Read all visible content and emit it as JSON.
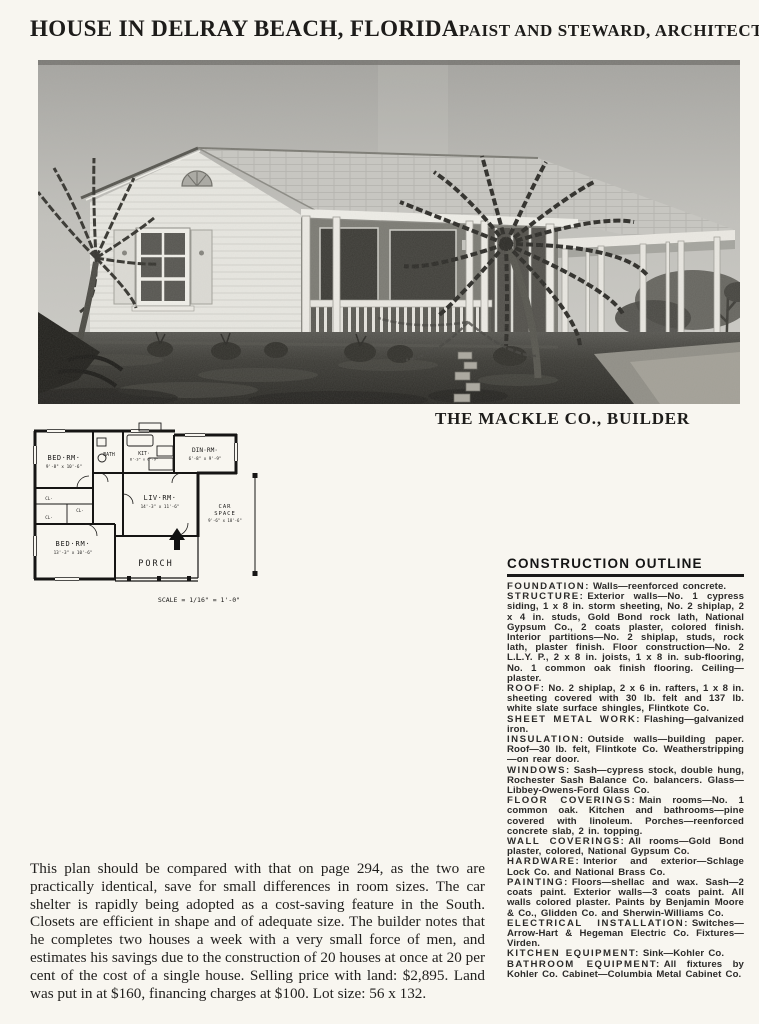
{
  "header": {
    "title": "HOUSE IN DELRAY BEACH, FLORIDA",
    "architects": "PAIST AND STEWARD, ARCHITECTS"
  },
  "photo": {
    "caption": "THE MACKLE CO., BUILDER"
  },
  "floor_plan": {
    "rooms": {
      "bedroom1": {
        "name": "BED·RM·",
        "dims": "9'-8\" x 10'-6\""
      },
      "bath": {
        "name": "BATH"
      },
      "kitchen": {
        "name": "KIT·",
        "dims": "8'-3\" x 6'-9\""
      },
      "dining": {
        "name": "DIN·RM·",
        "dims": "6'-8\" x 9'-9\""
      },
      "living": {
        "name": "LIV·RM·",
        "dims": "14'-3\" x 11'-6\""
      },
      "bedroom2": {
        "name": "BED·RM·",
        "dims": "13'-3\" x 10'-6\""
      },
      "porch": {
        "name": "PORCH"
      },
      "car_space": {
        "line1": "CAR",
        "line2": "SPACE",
        "dims": "9'-6\" x 18'-6\""
      }
    },
    "closet_label": "CL·",
    "scale": "SCALE = 1/16\" = 1'-0\""
  },
  "construction_outline": {
    "heading": "CONSTRUCTION OUTLINE",
    "items": [
      {
        "label": "FOUNDATION:",
        "text": "Walls—reenforced concrete."
      },
      {
        "label": "STRUCTURE:",
        "text": "Exterior walls—No. 1 cypress siding, 1 x 8 in. storm sheeting, No. 2 shiplap, 2 x 4 in. studs, Gold Bond rock lath, National Gypsum Co., 2 coats plaster, colored finish. Interior partitions—No. 2 shiplap, studs, rock lath, plaster finish. Floor construction—No. 2 L.L.Y. P., 2 x 8 in. joists, 1 x 8 in. sub-flooring, No. 1 common oak finish flooring. Ceiling—plaster."
      },
      {
        "label": "ROOF:",
        "text": "No. 2 shiplap, 2 x 6 in. rafters, 1 x 8 in. sheeting covered with 30 lb. felt and 137 lb. white slate surface shingles, Flintkote Co."
      },
      {
        "label": "SHEET METAL WORK:",
        "text": "Flashing—galvanized iron."
      },
      {
        "label": "INSULATION:",
        "text": "Outside walls—building paper. Roof—30 lb. felt, Flintkote Co. Weatherstripping—on rear door."
      },
      {
        "label": "WINDOWS:",
        "text": "Sash—cypress stock, double hung, Rochester Sash Balance Co. balancers. Glass—Libbey-Owens-Ford Glass Co."
      },
      {
        "label": "FLOOR COVERINGS:",
        "text": "Main rooms—No. 1 common oak. Kitchen and bathrooms—pine covered with linoleum. Porches—reenforced concrete slab, 2 in. topping."
      },
      {
        "label": "WALL COVERINGS:",
        "text": "All rooms—Gold Bond plaster, colored, National Gypsum Co."
      },
      {
        "label": "HARDWARE:",
        "text": "Interior and exterior—Schlage Lock Co. and National Brass Co."
      },
      {
        "label": "PAINTING:",
        "text": "Floors—shellac and wax. Sash—2 coats paint. Exterior walls—3 coats paint. All walls colored plaster. Paints by Benjamin Moore & Co., Glidden Co. and Sherwin-Williams Co."
      },
      {
        "label": "ELECTRICAL INSTALLATION:",
        "text": "Switches—Arrow-Hart & Hegeman Electric Co. Fixtures—Virden."
      },
      {
        "label": "KITCHEN EQUIPMENT:",
        "text": "Sink—Kohler Co."
      },
      {
        "label": "BATHROOM EQUIPMENT:",
        "text": "All fixtures by Kohler Co. Cabinet—Columbia Metal Cabinet Co."
      }
    ]
  },
  "description": {
    "paragraph": "This plan should be compared with that on page 294, as the two are practically identical, save for small differences in room sizes. The car shelter is rapidly being adopted as a cost-saving feature in the South. Closets are efficient in shape and of adequate size. The builder notes that he completes two houses a week with a very small force of men, and estimates his savings due to the construction of 20 houses at once at 20 per cent of the cost of a single house. Selling price with land: $2,895. Land was put in at $160, financing charges at $100. Lot size: 56 x 132."
  }
}
